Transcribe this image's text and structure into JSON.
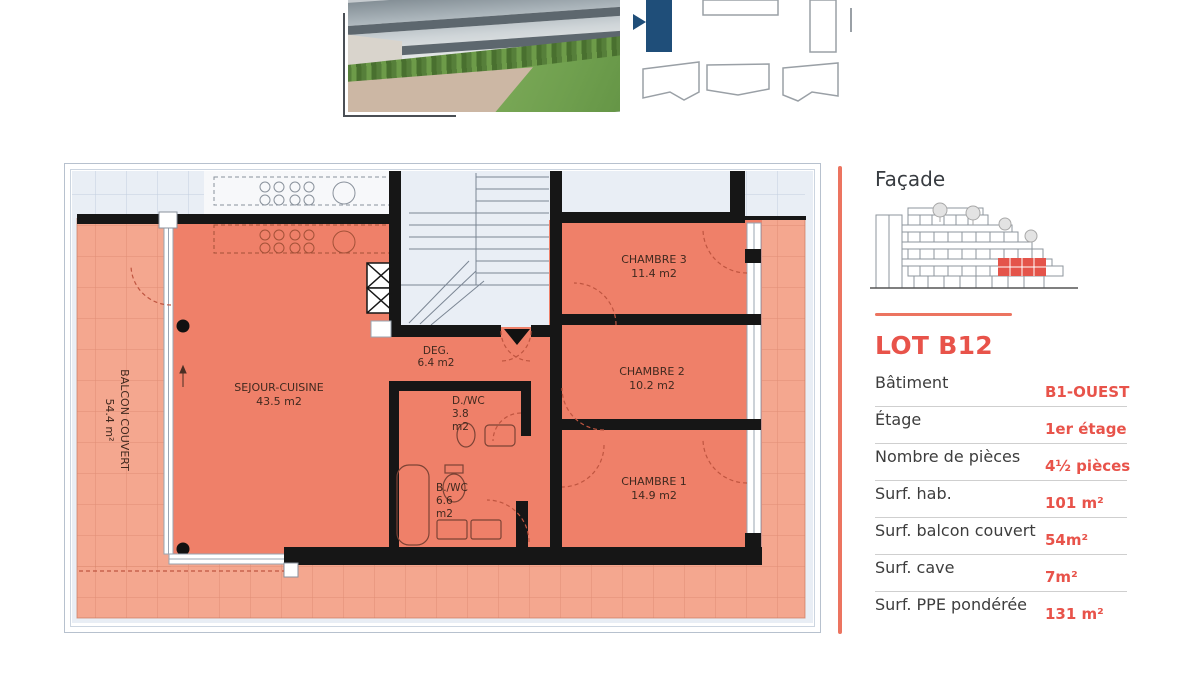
{
  "plan": {
    "rooms": {
      "sejour": {
        "name": "SEJOUR-CUISINE",
        "area": "43.5 m2"
      },
      "deg": {
        "name": "DEG.",
        "area": "6.4 m2"
      },
      "dwc": {
        "name": "D./WC",
        "area_value": "3.8",
        "area_unit": "m2"
      },
      "bwc": {
        "name": "B./WC",
        "area_value": "6.6",
        "area_unit": "m2"
      },
      "chambre3": {
        "name": "CHAMBRE 3",
        "area": "11.4 m2"
      },
      "chambre2": {
        "name": "CHAMBRE 2",
        "area": "10.2 m2"
      },
      "chambre1": {
        "name": "CHAMBRE 1",
        "area": "14.9 m2"
      },
      "balcon": {
        "name": "BALCON COUVERT",
        "area": "54.4 m²"
      }
    }
  },
  "panel": {
    "facade_title": "Façade",
    "lot_title": "LOT B12",
    "rows": [
      {
        "label": "Bâtiment",
        "value": "B1-OUEST"
      },
      {
        "label": "Étage",
        "value": "1er étage"
      },
      {
        "label": "Nombre de pièces",
        "value": "4½ pièces"
      },
      {
        "label": "Surf. hab.",
        "value": "101 m²"
      },
      {
        "label": "Surf. balcon couvert",
        "value": "54m²"
      },
      {
        "label": "Surf. cave",
        "value": "7m²"
      },
      {
        "label": "Surf. PPE pondérée",
        "value": "131 m²"
      }
    ]
  },
  "colors": {
    "accent": "#e8534a",
    "divider": "#ec7460",
    "apartment_fill": "#ef8069",
    "balcony_fill": "#f4a78f",
    "outside_fill": "#e9eef5",
    "wall": "#161616",
    "selected_building": "#1f4e79",
    "facade_highlight": "#e4544a"
  }
}
